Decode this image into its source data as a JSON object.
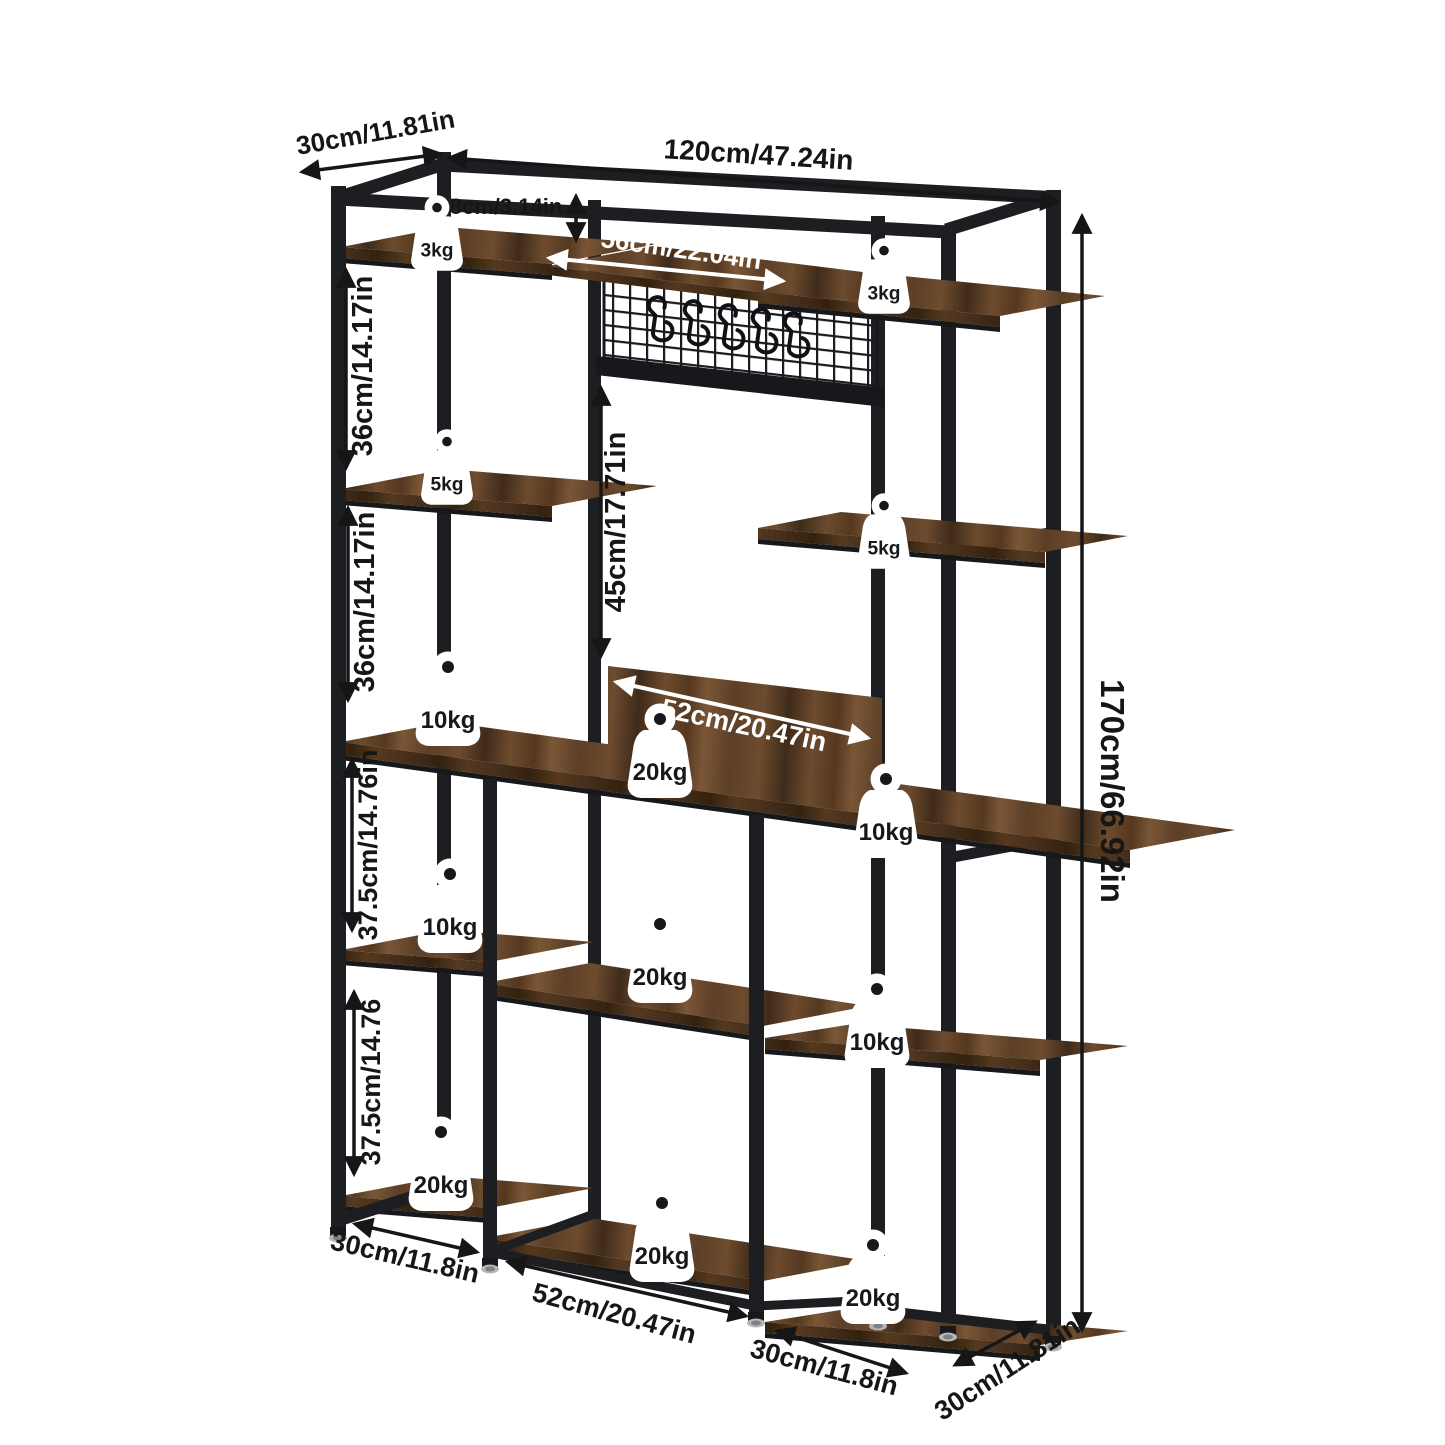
{
  "diagram_type": "furniture-dimension-diagram",
  "product": "industrial bakers rack / kitchen storage shelf",
  "colors": {
    "background": "#ffffff",
    "frame": "#1d1e22",
    "frame_dark": "#17181b",
    "wood_light": "#7a5636",
    "wood_mid": "#5c3f27",
    "wood_dark": "#452e1b",
    "mesh": "#191a1e",
    "label": "#161616",
    "arrow_white": "#ffffff",
    "badge_bg": "#ffffff",
    "badge_text": "#17181b",
    "foot_metal": "#b5b6ba"
  },
  "dims": {
    "top_depth": "30cm/11.81in",
    "top_width": "120cm/47.24in",
    "top_shelf_gap": "8cm/3.14in",
    "hook_bar_width": "56cm/22.04in",
    "left_upper_section": "36cm/14.17in",
    "left_middle_section": "36cm/14.17in",
    "center_opening_height": "45cm/17.71in",
    "backsplash_width": "52cm/20.47in",
    "left_lower_section_1": "37.5cm/14.76in",
    "left_lower_section_2": "37.5cm/14.76",
    "total_height": "170cm/66.92in",
    "bottom_left_width": "30cm/11.8in",
    "bottom_center_width": "52cm/20.47in",
    "bottom_right_width": "30cm/11.8in",
    "bottom_right_depth": "30cm/11.81in"
  },
  "weights": [
    {
      "location": "top-left-shelf",
      "label": "3kg"
    },
    {
      "location": "top-right-shelf",
      "label": "3kg"
    },
    {
      "location": "upper-left-shelf",
      "label": "5kg"
    },
    {
      "location": "middle-right-shelf",
      "label": "5kg"
    },
    {
      "location": "desktop-left",
      "label": "10kg"
    },
    {
      "location": "desktop-center",
      "label": "20kg"
    },
    {
      "location": "desktop-right",
      "label": "10kg"
    },
    {
      "location": "lower-left-shelf",
      "label": "10kg"
    },
    {
      "location": "lower-center-shelf",
      "label": "20kg"
    },
    {
      "location": "lower-right-shelf",
      "label": "10kg"
    },
    {
      "location": "bottom-left-shelf",
      "label": "20kg"
    },
    {
      "location": "bottom-center-shelf",
      "label": "20kg"
    },
    {
      "location": "bottom-right-shelf",
      "label": "20kg"
    }
  ],
  "hook_panel": {
    "hook_count": 5
  }
}
